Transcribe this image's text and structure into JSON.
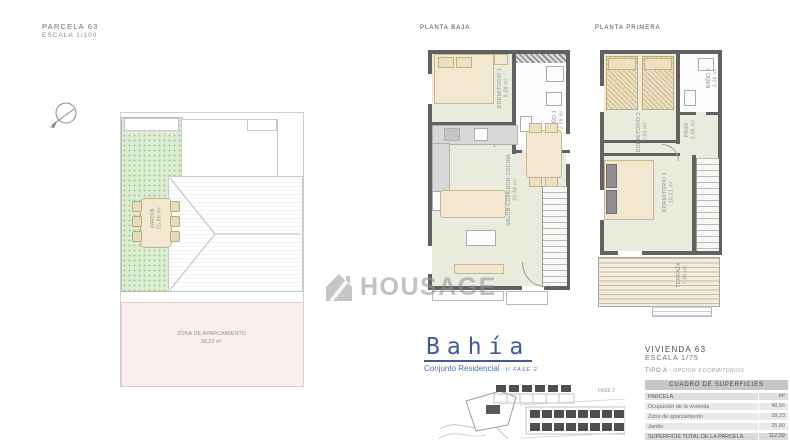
{
  "header": {
    "title": "PARCELA 63",
    "scale": "ESCALA 1/100"
  },
  "site_plan": {
    "jardin": {
      "name": "JARDÍN",
      "area": "25,80 m²"
    },
    "parking": {
      "name": "ZONA DE APARCAMIENTO",
      "area": "38,23 m²"
    }
  },
  "planta_baja": {
    "title": "PLANTA BAJA",
    "bedroom": {
      "name": "DORMITORIO 3",
      "area": "9,28 m²"
    },
    "bath": {
      "name": "BAÑO 1",
      "area": "3,06 m²"
    },
    "living": {
      "name": "SALÓN-COMEDOR-COCINA",
      "area": "20,46 m²"
    }
  },
  "planta_primera": {
    "title": "PLANTA PRIMERA",
    "bedroom2": {
      "name": "DORMITORIO 2",
      "area": "8,01 m²"
    },
    "bath": {
      "name": "BAÑO 2",
      "area": "3,06 m²"
    },
    "paso": {
      "name": "PASO",
      "area": "2,06 m²"
    },
    "bedroom1": {
      "name": "DORMITORIO 1",
      "area": "10,21 m²"
    },
    "terraza": {
      "name": "TERRAZA",
      "area": "7,95 m²"
    }
  },
  "watermark": {
    "text": "HOUSAGE"
  },
  "brand": {
    "name": "Bahía",
    "subtitle": "Conjunto Residencial",
    "phase": "II FASE 2"
  },
  "vivienda": {
    "title": "VIVIENDA 63",
    "scale": "ESCALA 1/75",
    "tipo": "TIPO A",
    "opcion": "- OPCIÓN 3 DORMITORIOS"
  },
  "surface_table": {
    "title": "CUADRO DE SUPERFICIES",
    "col_header": {
      "label": "PARCELA",
      "unit": "m²"
    },
    "rows": [
      {
        "label": "Ocupación de la vivienda",
        "value": "48,56"
      },
      {
        "label": "Zona de aparcamiento",
        "value": "38,23"
      },
      {
        "label": "Jardín",
        "value": "25,80"
      }
    ],
    "total": {
      "label": "SUPERFICIE TOTAL DE LA PARCELA",
      "value": "112,59"
    }
  },
  "site_map": {
    "label": "FASE 2"
  }
}
